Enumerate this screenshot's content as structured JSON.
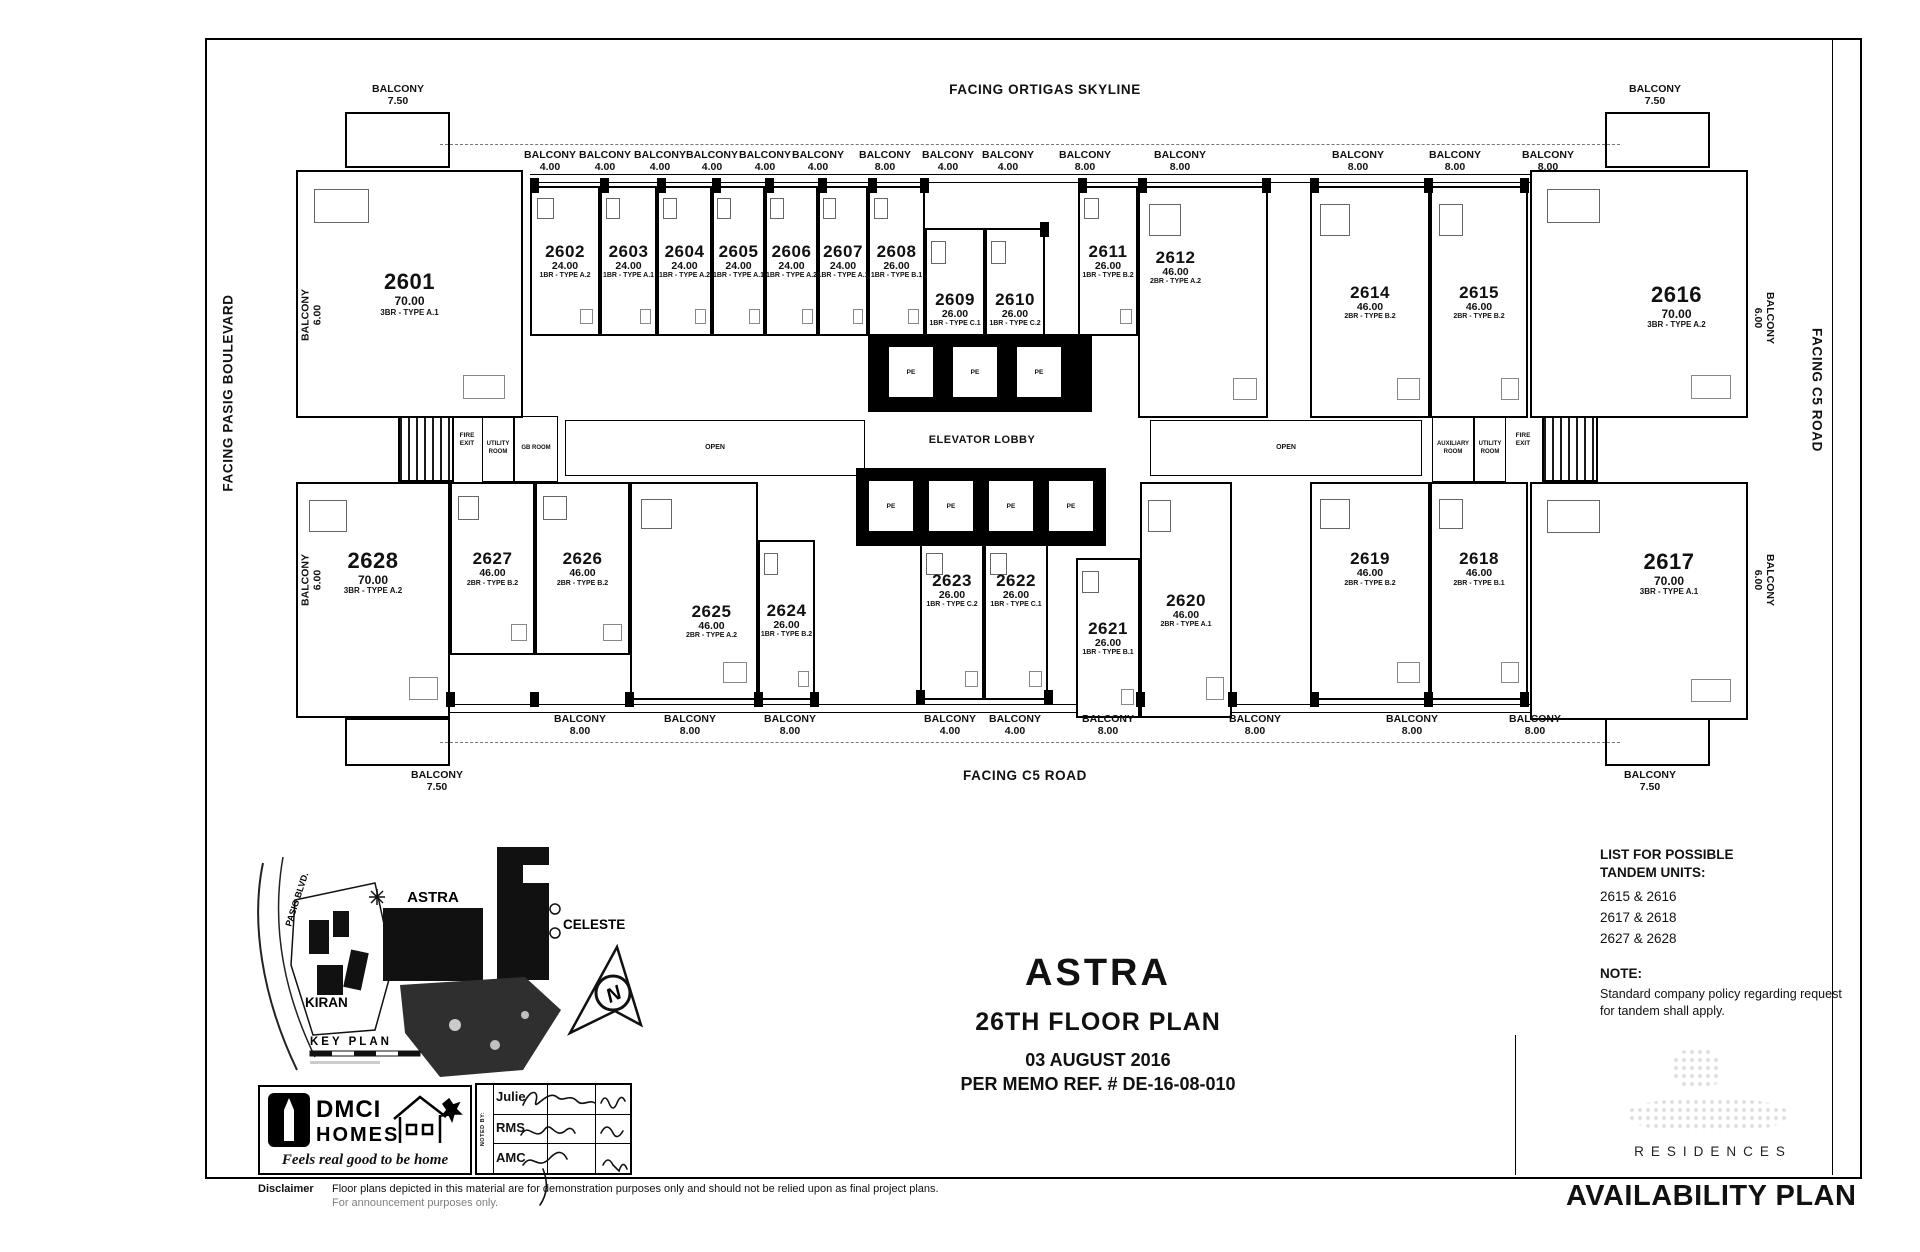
{
  "facing": {
    "top": "FACING ORTIGAS SKYLINE",
    "left": "FACING PASIG BOULEVARD",
    "right": "FACING C5 ROAD",
    "bottom": "FACING C5 ROAD"
  },
  "strings": {
    "balcony": "BALCONY"
  },
  "balcony_values": [
    "7.50",
    "4.00",
    "4.00",
    "4.00",
    "4.00",
    "4.00",
    "4.00",
    "8.00",
    "4.00",
    "4.00",
    "8.00",
    "8.00",
    "8.00",
    "8.00",
    "8.00",
    "7.50",
    "6.00",
    "6.00",
    "6.00",
    "6.00",
    "7.50",
    "8.00",
    "8.00",
    "8.00",
    "4.00",
    "4.00",
    "8.00",
    "8.00",
    "8.00",
    "8.00",
    "7.50"
  ],
  "units": [
    {
      "no": "2601",
      "area": "70.00",
      "type": "3BR - TYPE A.1"
    },
    {
      "no": "2602",
      "area": "24.00",
      "type": "1BR - TYPE A.2"
    },
    {
      "no": "2603",
      "area": "24.00",
      "type": "1BR - TYPE A.1"
    },
    {
      "no": "2604",
      "area": "24.00",
      "type": "1BR - TYPE A.2"
    },
    {
      "no": "2605",
      "area": "24.00",
      "type": "1BR - TYPE A.1"
    },
    {
      "no": "2606",
      "area": "24.00",
      "type": "1BR - TYPE A.2"
    },
    {
      "no": "2607",
      "area": "24.00",
      "type": "1BR - TYPE A.1"
    },
    {
      "no": "2608",
      "area": "26.00",
      "type": "1BR - TYPE B.1"
    },
    {
      "no": "2609",
      "area": "26.00",
      "type": "1BR - TYPE C.1"
    },
    {
      "no": "2610",
      "area": "26.00",
      "type": "1BR - TYPE C.2"
    },
    {
      "no": "2611",
      "area": "26.00",
      "type": "1BR - TYPE B.2"
    },
    {
      "no": "2612",
      "area": "46.00",
      "type": "2BR - TYPE A.2"
    },
    {
      "no": "2614",
      "area": "46.00",
      "type": "2BR - TYPE B.2"
    },
    {
      "no": "2615",
      "area": "46.00",
      "type": "2BR - TYPE B.2"
    },
    {
      "no": "2616",
      "area": "70.00",
      "type": "3BR - TYPE A.2"
    },
    {
      "no": "2617",
      "area": "70.00",
      "type": "3BR - TYPE A.1"
    },
    {
      "no": "2618",
      "area": "46.00",
      "type": "2BR - TYPE B.1"
    },
    {
      "no": "2619",
      "area": "46.00",
      "type": "2BR - TYPE B.2"
    },
    {
      "no": "2620",
      "area": "46.00",
      "type": "2BR - TYPE A.1"
    },
    {
      "no": "2621",
      "area": "26.00",
      "type": "1BR - TYPE B.1"
    },
    {
      "no": "2622",
      "area": "26.00",
      "type": "1BR - TYPE C.1"
    },
    {
      "no": "2623",
      "area": "26.00",
      "type": "1BR - TYPE C.2"
    },
    {
      "no": "2624",
      "area": "26.00",
      "type": "1BR - TYPE B.2"
    },
    {
      "no": "2625",
      "area": "46.00",
      "type": "2BR - TYPE A.2"
    },
    {
      "no": "2626",
      "area": "46.00",
      "type": "2BR - TYPE B.2"
    },
    {
      "no": "2627",
      "area": "46.00",
      "type": "2BR - TYPE B.2"
    },
    {
      "no": "2628",
      "area": "70.00",
      "type": "3BR - TYPE A.2"
    }
  ],
  "core": {
    "elevator_lobby": "ELEVATOR LOBBY",
    "pe": "PE",
    "open": "OPEN",
    "fire_exit": "FIRE EXIT",
    "utility_room": "UTILITY ROOM",
    "gb_room": "GB ROOM",
    "auxiliary_room": "AUXILIARY ROOM"
  },
  "key_plan": {
    "astra": "ASTRA",
    "celeste": "CELESTE",
    "kiran": "KIRAN",
    "road": "PASIG BLVD.",
    "label": "KEY PLAN",
    "north": "N"
  },
  "title_block": {
    "project": "ASTRA",
    "floor": "26TH FLOOR PLAN",
    "date": "03 AUGUST 2016",
    "memo": "PER MEMO REF. #  DE-16-08-010"
  },
  "tandem": {
    "heading": "LIST FOR POSSIBLE TANDEM UNITS:",
    "pairs": [
      "2615 & 2616",
      "2617 & 2618",
      "2627 & 2628"
    ]
  },
  "note": {
    "heading": "NOTE:",
    "body": "Standard company policy regarding request for tandem shall apply."
  },
  "branding": {
    "dmci_line1": "DMCI",
    "dmci_line2": "HOMES",
    "tagline": "Feels real good to be home",
    "residences": "RESIDENCES",
    "availability_plan": "AVAILABILITY PLAN"
  },
  "signoff": {
    "noted_by": "NOTED BY:",
    "rows": [
      {
        "label": "Julie"
      },
      {
        "label": "RMS"
      },
      {
        "label": "AMC"
      }
    ]
  },
  "disclaimer": {
    "label": "Disclaimer",
    "line1": "Floor plans depicted in this material are for demonstration purposes only and should not be relied upon as final project plans.",
    "line2": "For announcement purposes only."
  }
}
